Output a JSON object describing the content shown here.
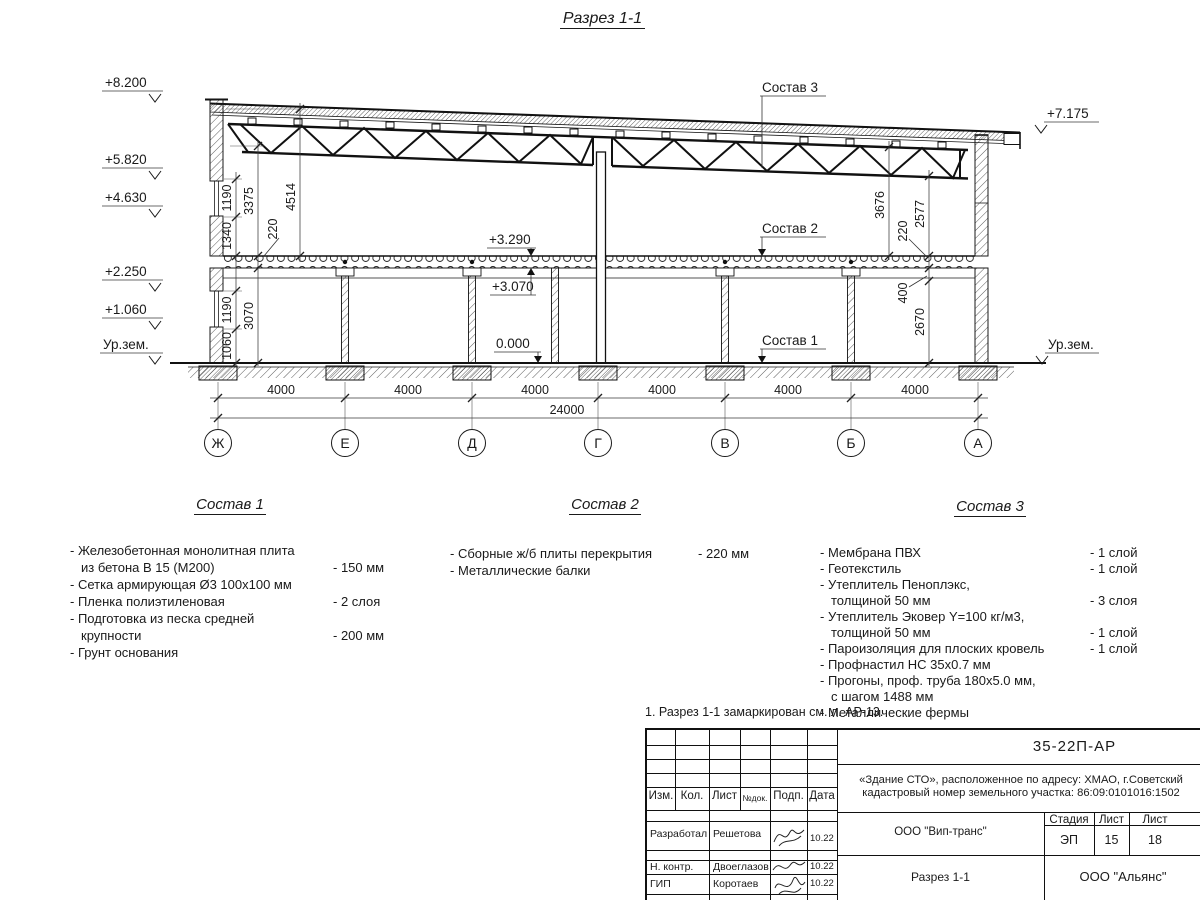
{
  "page": {
    "title": "Разрез 1-1"
  },
  "colors": {
    "ink": "#1a1a1a",
    "paper": "#ffffff"
  },
  "drawing": {
    "elev_left": [
      "+8.200",
      "+5.820",
      "+4.630",
      "+2.250",
      "+1.060",
      "Ур.зем."
    ],
    "elev_right": [
      "+7.175",
      "Ур.зем."
    ],
    "levels": {
      "slab_top": "+3.290",
      "slab_bottom": "+3.070",
      "zero": "0.000"
    },
    "callouts": {
      "s1": "Состав 1",
      "s2": "Состав 2",
      "s3": "Состав 3"
    },
    "dims": {
      "v1190a": "1190",
      "v1340": "1340",
      "v3375": "3375",
      "v4514": "4514",
      "v220l": "220",
      "v1190b": "1190",
      "v1060": "1060",
      "v3070": "3070",
      "v3676": "3676",
      "v2577": "2577",
      "v220r": "220",
      "v400": "400",
      "v2670": "2670",
      "bays": [
        "4000",
        "4000",
        "4000",
        "4000",
        "4000",
        "4000"
      ],
      "total": "24000"
    },
    "axes": [
      "Ж",
      "Е",
      "Д",
      "Г",
      "В",
      "Б",
      "А"
    ]
  },
  "compositions": [
    {
      "title": "Состав 1",
      "rows": [
        {
          "t": "- Железобетонная  монолитная плита",
          "v": ""
        },
        {
          "t": "из бетона В 15 (М200)",
          "v": "- 150 мм"
        },
        {
          "t": "- Сетка армирующая Ø3 100х100 мм",
          "v": ""
        },
        {
          "t": "- Пленка полиэтиленовая",
          "v": "- 2 слоя"
        },
        {
          "t": "- Подготовка из песка средней",
          "v": ""
        },
        {
          "t": "крупности",
          "v": "- 200 мм"
        },
        {
          "t": "- Грунт основания",
          "v": ""
        }
      ]
    },
    {
      "title": "Состав 2",
      "rows": [
        {
          "t": "- Сборные ж/б плиты перекрытия",
          "v": "- 220 мм"
        },
        {
          "t": "- Металлические балки",
          "v": ""
        }
      ]
    },
    {
      "title": "Состав 3",
      "rows": [
        {
          "t": "- Мембрана ПВХ",
          "v": "- 1 слой"
        },
        {
          "t": "- Геотекстиль",
          "v": "- 1 слой"
        },
        {
          "t": "- Утеплитель Пеноплэкс,",
          "v": ""
        },
        {
          "t": "толщиной 50 мм",
          "v": "- 3 слоя"
        },
        {
          "t": "- Утеплитель Эковер Y=100 кг/м3,",
          "v": ""
        },
        {
          "t": "толщиной 50 мм",
          "v": "- 1 слой"
        },
        {
          "t": "- Пароизоляция для плоских кровель",
          "v": "- 1 слой"
        },
        {
          "t": "- Профнастил НС 35х0.7 мм",
          "v": ""
        },
        {
          "t": "- Прогоны, проф. труба 180х5.0 мм,",
          "v": ""
        },
        {
          "t": "с шагом 1488 мм",
          "v": ""
        },
        {
          "t": "- Металлические фермы",
          "v": ""
        }
      ]
    }
  ],
  "note": "1. Разрез 1-1 замаркирован см. л. АР-13.",
  "title_block": {
    "doc_number": "35-22П-АР",
    "object_line1": "«Здание СТО», расположенное по адресу: ХМАО, г.Советский",
    "object_line2": "кадастровый номер земельного участка: 86:09:0101016:1502",
    "cols": [
      "Изм.",
      "Кол.",
      "Лист",
      "№док.",
      "Подп.",
      "Дата"
    ],
    "sign_rows": [
      {
        "role": "Разработал",
        "name": "Решетова",
        "date": "10.22"
      },
      {
        "role": "Н. контр.",
        "name": "Двоеглазов",
        "date": "10.22"
      },
      {
        "role": "ГИП",
        "name": "Коротаев",
        "date": "10.22"
      }
    ],
    "org_center": "ООО \"Вип-транс\"",
    "stage_cols": [
      "Стадия",
      "Лист",
      "Лист"
    ],
    "stage_vals": [
      "ЭП",
      "15",
      "18"
    ],
    "sheet_name": "Разрез 1-1",
    "org_right": "ООО \"Альянс\""
  }
}
